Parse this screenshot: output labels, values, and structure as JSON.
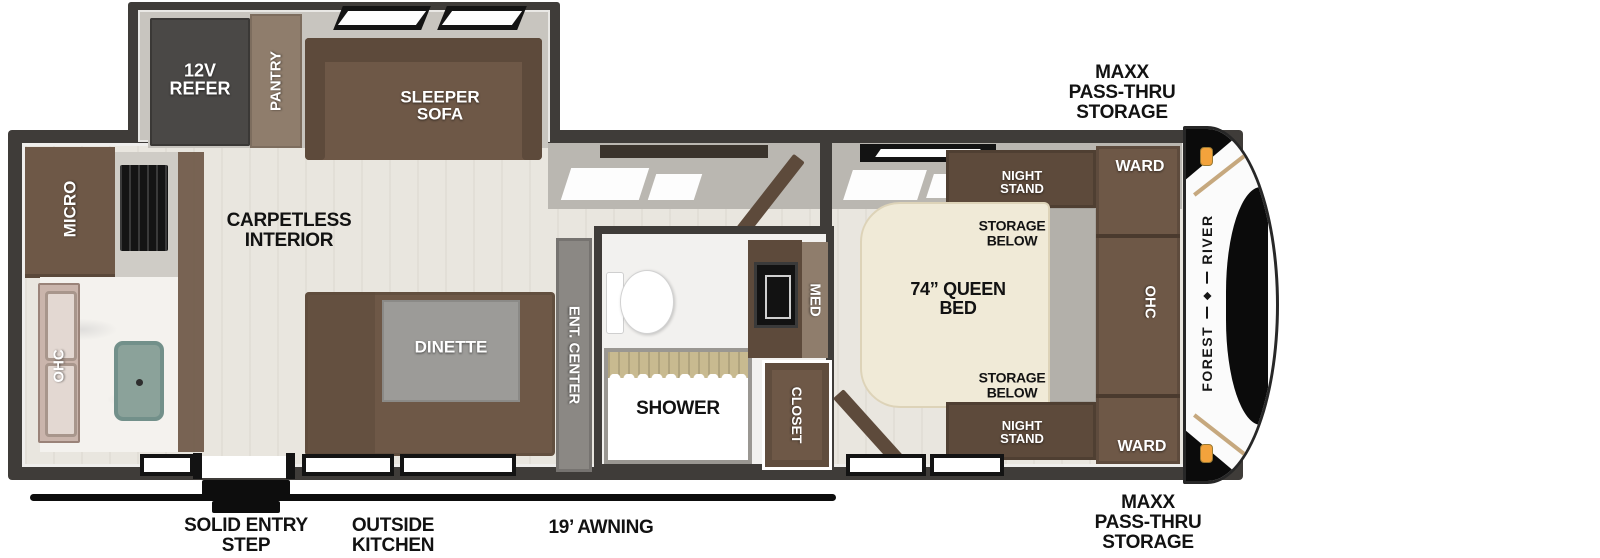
{
  "colors": {
    "wall": "#3f3c39",
    "floor": "#e9e6df",
    "furniture_brown": "#6e5847",
    "furniture_brown_dark": "#5d4a3b",
    "taupe": "#8f7d6c",
    "bed_cream": "#f0ead7",
    "table_gray": "#9c9b98",
    "shower_khaki": "#c8ba90",
    "marker_amber": "#f3a33c"
  },
  "slideout": {
    "refer": "12V\nREFER",
    "pantry": "PANTRY",
    "sleeper_sofa": "SLEEPER\nSOFA"
  },
  "kitchen": {
    "micro": "MICRO",
    "ohc": "OHC"
  },
  "living": {
    "carpetless_note": "CARPETLESS\nINTERIOR",
    "dinette": "DINETTE",
    "ent_center": "ENT. CENTER"
  },
  "bath": {
    "shower": "SHOWER",
    "med": "MED",
    "closet": "CLOSET"
  },
  "bedroom": {
    "night_stand_top": "NIGHT\nSTAND",
    "storage_below_top": "STORAGE\nBELOW",
    "queen_bed": "74” QUEEN\nBED",
    "storage_below_bottom": "STORAGE\nBELOW",
    "night_stand_bottom": "NIGHT\nSTAND",
    "ward_top": "WARD",
    "ohc": "OHC",
    "ward_bottom": "WARD"
  },
  "front_cap": {
    "brand_first": "FOREST",
    "brand_second": "RIVER",
    "logo_glyph": "◆",
    "storage_top": "MAXX\nPASS-THRU\nSTORAGE",
    "storage_bottom": "MAXX\nPASS-THRU\nSTORAGE"
  },
  "exterior": {
    "solid_entry_step": "SOLID ENTRY\nSTEP",
    "outside_kitchen": "OUTSIDE\nKITCHEN",
    "awning": "19’ AWNING"
  }
}
